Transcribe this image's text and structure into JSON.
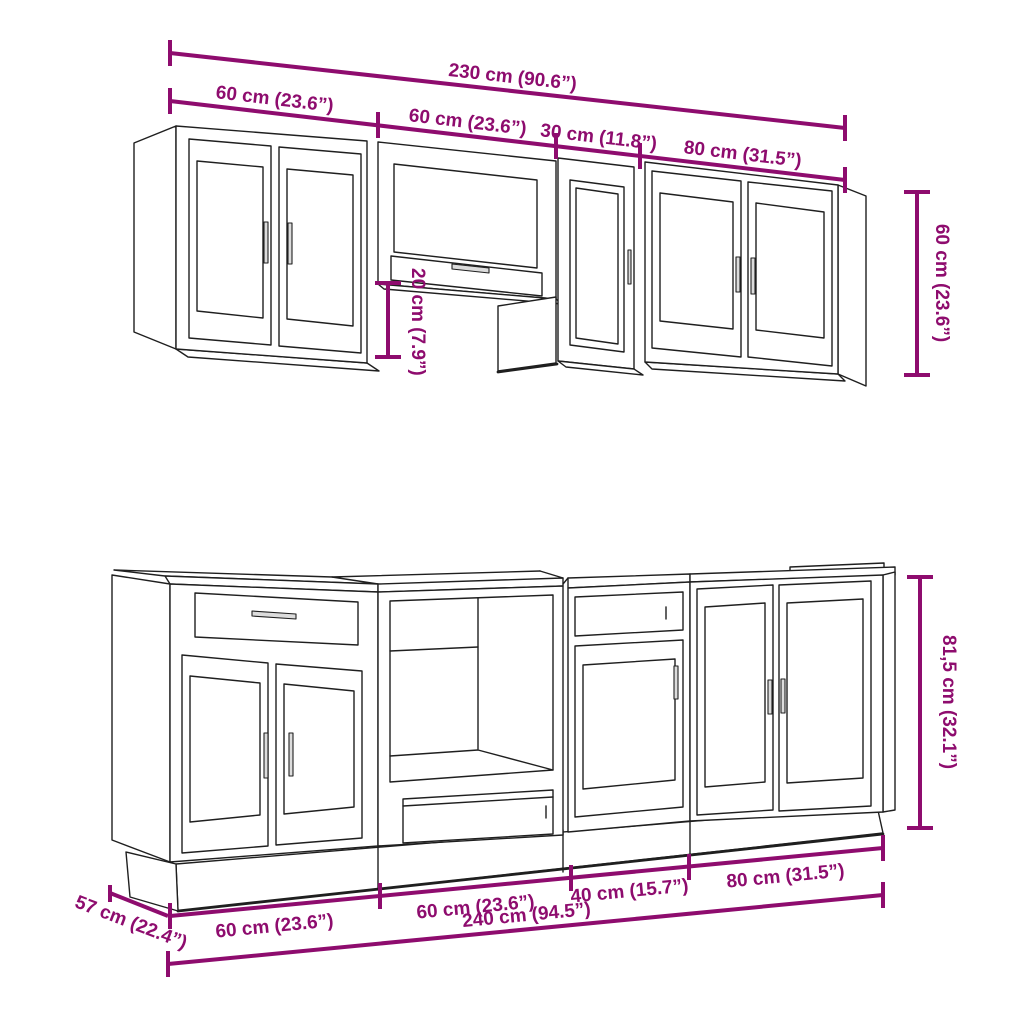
{
  "colors": {
    "background": "#ffffff",
    "drawing_lines": "#1f1f1f",
    "dimension_lines": "#8e0c6e"
  },
  "wall_cabinets": {
    "overall_width": "230 cm (90.6”)",
    "unit_widths": [
      "60 cm (23.6”)",
      "60 cm (23.6”)",
      "30 cm (11.8”)",
      "80 cm (31.5”)"
    ],
    "height": "60 cm (23.6”)",
    "hood_clearance": "20 cm (7.9”)"
  },
  "base_cabinets": {
    "unit_widths": [
      "60 cm (23.6”)",
      "60 cm (23.6”)",
      "40 cm (15.7”)",
      "80 cm (31.5”)"
    ],
    "overall_width": "240 cm (94.5”)",
    "depth": "57 cm (22.4”)",
    "height": "81,5 cm (32.1”)"
  }
}
